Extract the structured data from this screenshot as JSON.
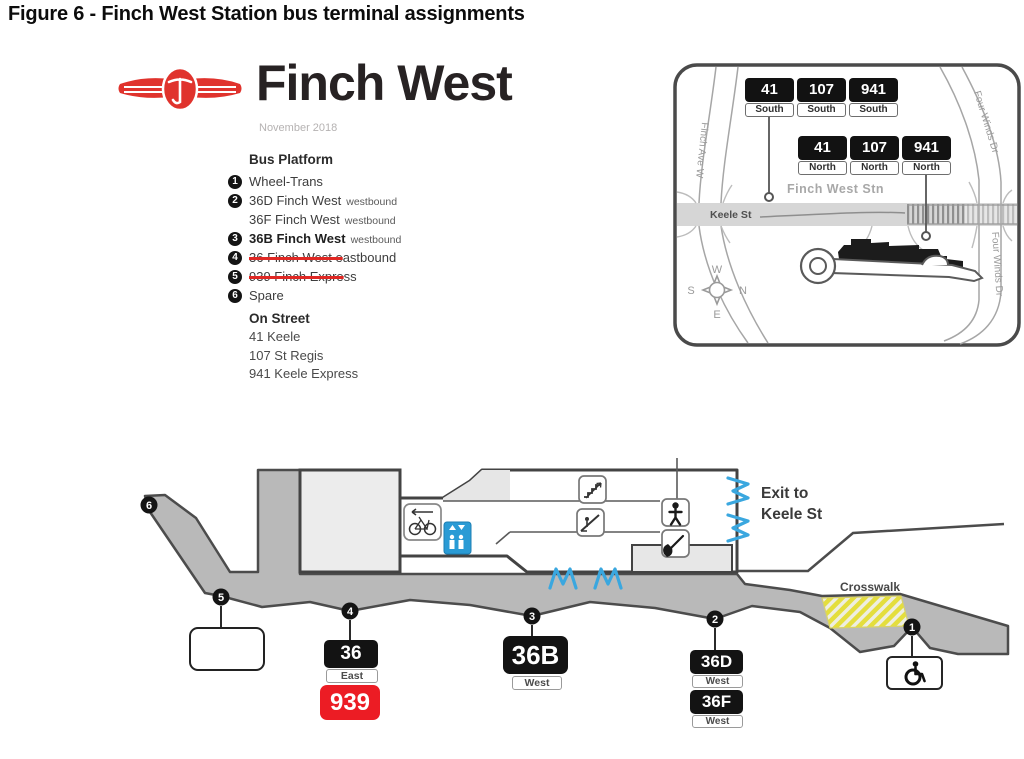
{
  "figure_title": "Figure 6 - Finch West Station bus terminal assignments",
  "station": {
    "name": "Finch West",
    "date": "November 2018",
    "logo": "ttc-logo"
  },
  "bus_platform": {
    "heading": "Bus Platform",
    "items": [
      {
        "num": "1",
        "struck": "",
        "text": "Wheel-Trans",
        "suffix": ""
      },
      {
        "num": "2",
        "struck": "",
        "text": "36D Finch West",
        "suffix": "westbound"
      },
      {
        "num": "",
        "struck": "",
        "text": "36F Finch West",
        "suffix": "westbound"
      },
      {
        "num": "3",
        "struck": "",
        "text": "36B Finch West",
        "suffix": "westbound"
      },
      {
        "num": "4",
        "struck": "36 Finch West e",
        "text": "astbound",
        "suffix": ""
      },
      {
        "num": "5",
        "struck": "939 Finch Expre",
        "text": "ss",
        "suffix": ""
      },
      {
        "num": "6",
        "struck": "",
        "text": "Spare",
        "suffix": ""
      }
    ]
  },
  "on_street": {
    "heading": "On Street",
    "items": [
      "41 Keele",
      "107 St Regis",
      "941 Keele Express"
    ]
  },
  "map": {
    "stn_label": "Finch West Stn",
    "street_keele": "Keele St",
    "street_finch": "Finch Ave W",
    "street_fourwinds": "Four Winds Dr",
    "compass": {
      "w": "W",
      "s": "S",
      "n": "N",
      "e": "E"
    },
    "stops_south": [
      {
        "route": "41",
        "dir": "South"
      },
      {
        "route": "107",
        "dir": "South"
      },
      {
        "route": "941",
        "dir": "South"
      }
    ],
    "stops_north": [
      {
        "route": "41",
        "dir": "North"
      },
      {
        "route": "107",
        "dir": "North"
      },
      {
        "route": "941",
        "dir": "North"
      }
    ]
  },
  "terminal": {
    "exit_line1": "Exit to",
    "exit_line2": "Keele St",
    "crosswalk": "Crosswalk",
    "markers": {
      "m1": "1",
      "m2": "2",
      "m3": "3",
      "m4": "4",
      "m5": "5",
      "m6": "6"
    },
    "signs": {
      "p4": {
        "route": "36",
        "dir": "East",
        "express": "939"
      },
      "p3": {
        "route": "36B",
        "dir": "West"
      },
      "p2a": {
        "route": "36D",
        "dir": "West"
      },
      "p2b": {
        "route": "36F",
        "dir": "West"
      }
    },
    "icons": [
      "bicycle-icon",
      "elevator-icon",
      "stairs-icon",
      "escalator-icon",
      "person-icon",
      "construction-icon",
      "door-icon",
      "wheelchair-icon",
      "compass-icon"
    ]
  },
  "colors": {
    "ttc_red": "#e0332d",
    "express_red": "#ec1c24",
    "strike_red": "#e02824",
    "sign_black": "#131313",
    "platform_gray": "#b9b9b9",
    "door_blue": "#3aa7df",
    "crosswalk_yellow": "#e4de3d"
  }
}
